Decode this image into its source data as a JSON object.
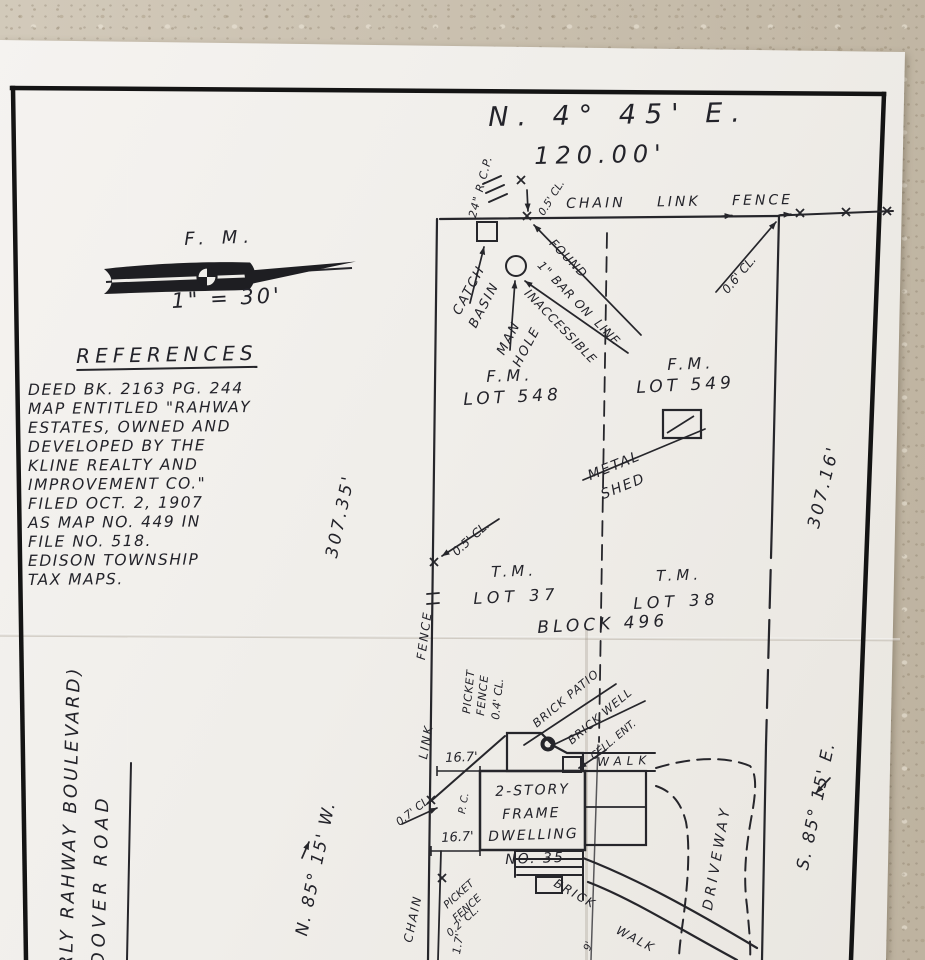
{
  "survey": {
    "top": {
      "bearing": "N. 4° 45' E.",
      "distance": "120.00'",
      "fence": "CHAIN LINK FENCE",
      "culvert": "24\" R.C.P.",
      "corner_offset": "0.5' CL.",
      "right_offset": "0.6' CL.",
      "catch_basin_1": "CATCH",
      "catch_basin_2": "BASIN",
      "manhole_1": "MAN",
      "manhole_2": "HOLE",
      "inaccessible": "INACCESSIBLE",
      "found_1": "FOUND",
      "found_2": "1\" BAR ON",
      "found_3": "LINE"
    },
    "compass": {
      "label": "F. M.",
      "scale": "1\" = 30'"
    },
    "references": {
      "title": "REFERENCES",
      "lines": [
        "DEED BK. 2163 PG. 244",
        "MAP ENTITLED \"RAHWAY",
        "ESTATES, OWNED AND",
        "DEVELOPED BY THE",
        "KLINE REALTY AND",
        "IMPROVEMENT CO.\"",
        "FILED OCT. 2, 1907",
        "AS MAP NO. 449 IN",
        "FILE NO. 518.",
        "EDISON TOWNSHIP",
        "TAX MAPS."
      ]
    },
    "west_side": {
      "distance": "307.35'",
      "bearing": "N. 85° 15' W.",
      "street_former": "RLY RAHWAY BOULEVARD)",
      "street": "DOVER ROAD",
      "fence_word_1": "FENCE",
      "fence_word_2": "LINK",
      "fence_word_3": "CHAIN",
      "mid_offset": "0.5' CL.",
      "offset_07": "0.7' CL.",
      "pc": "P. C.",
      "dim_upper": "16.7'",
      "dim_lower": "16.7'",
      "dim_fence": "1.7'",
      "picket_upper_1": "PICKET",
      "picket_upper_2": "FENCE",
      "picket_upper_3": "0.4' CL.",
      "picket_lower_1": "PICKET",
      "picket_lower_2": "FENCE",
      "picket_lower_3": "0.2' CL."
    },
    "east_side": {
      "distance": "307.16'",
      "bearing": "S. 85° 15' E."
    },
    "lots": {
      "fm_left_1": "F.M.",
      "fm_left_2": "LOT 548",
      "fm_right_1": "F.M.",
      "fm_right_2": "LOT 549",
      "tm_left_1": "T.M.",
      "tm_left_2": "LOT 37",
      "tm_right_1": "T.M.",
      "tm_right_2": "LOT 38",
      "block": "BLOCK 496"
    },
    "improvements": {
      "shed_1": "METAL",
      "shed_2": "SHED",
      "patio": "BRICK PATIO",
      "well": "BRICK WELL",
      "cellar": "CELL. ENT.",
      "walk": "WALK",
      "dwelling_1": "2-STORY",
      "dwelling_2": "FRAME",
      "dwelling_3": "DWELLING",
      "dwelling_4": "NO. 35",
      "brick_walk_1": "BRICK",
      "brick_walk_2": "WALK",
      "driveway": "DRIVEWAY",
      "walk_width": "9'"
    }
  }
}
